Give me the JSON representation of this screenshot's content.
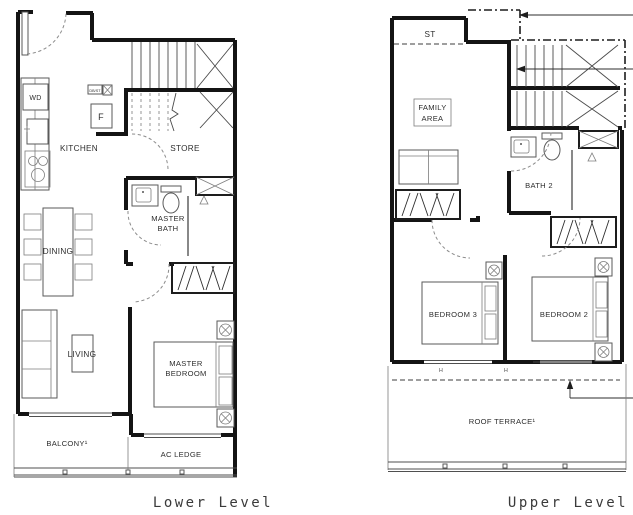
{
  "colors": {
    "wall": "#141414",
    "furniture_line": "#5a5a5a",
    "label_text": "#2e2e2e",
    "background": "#ffffff"
  },
  "lower": {
    "caption": "Lower Level",
    "labels": {
      "kitchen": "KITCHEN",
      "store": "STORE",
      "wd": "WD",
      "fridge": "F",
      "db_st": "DB/ST",
      "master_bath_1": "MASTER",
      "master_bath_2": "BATH",
      "dining": "DINING",
      "living": "LIVING",
      "master_bedroom_1": "MASTER",
      "master_bedroom_2": "BEDROOM",
      "balcony": "BALCONY¹",
      "ac_ledge": "AC LEDGE"
    }
  },
  "upper": {
    "caption": "Upper Level",
    "labels": {
      "st": "ST",
      "family_area_1": "FAMILY",
      "family_area_2": "AREA",
      "bath2": "BATH 2",
      "bedroom3": "BEDROOM 3",
      "bedroom2": "BEDROOM 2",
      "roof_terrace": "ROOF TERRACE¹",
      "window_marker_1": "H",
      "window_marker_2": "H"
    }
  }
}
